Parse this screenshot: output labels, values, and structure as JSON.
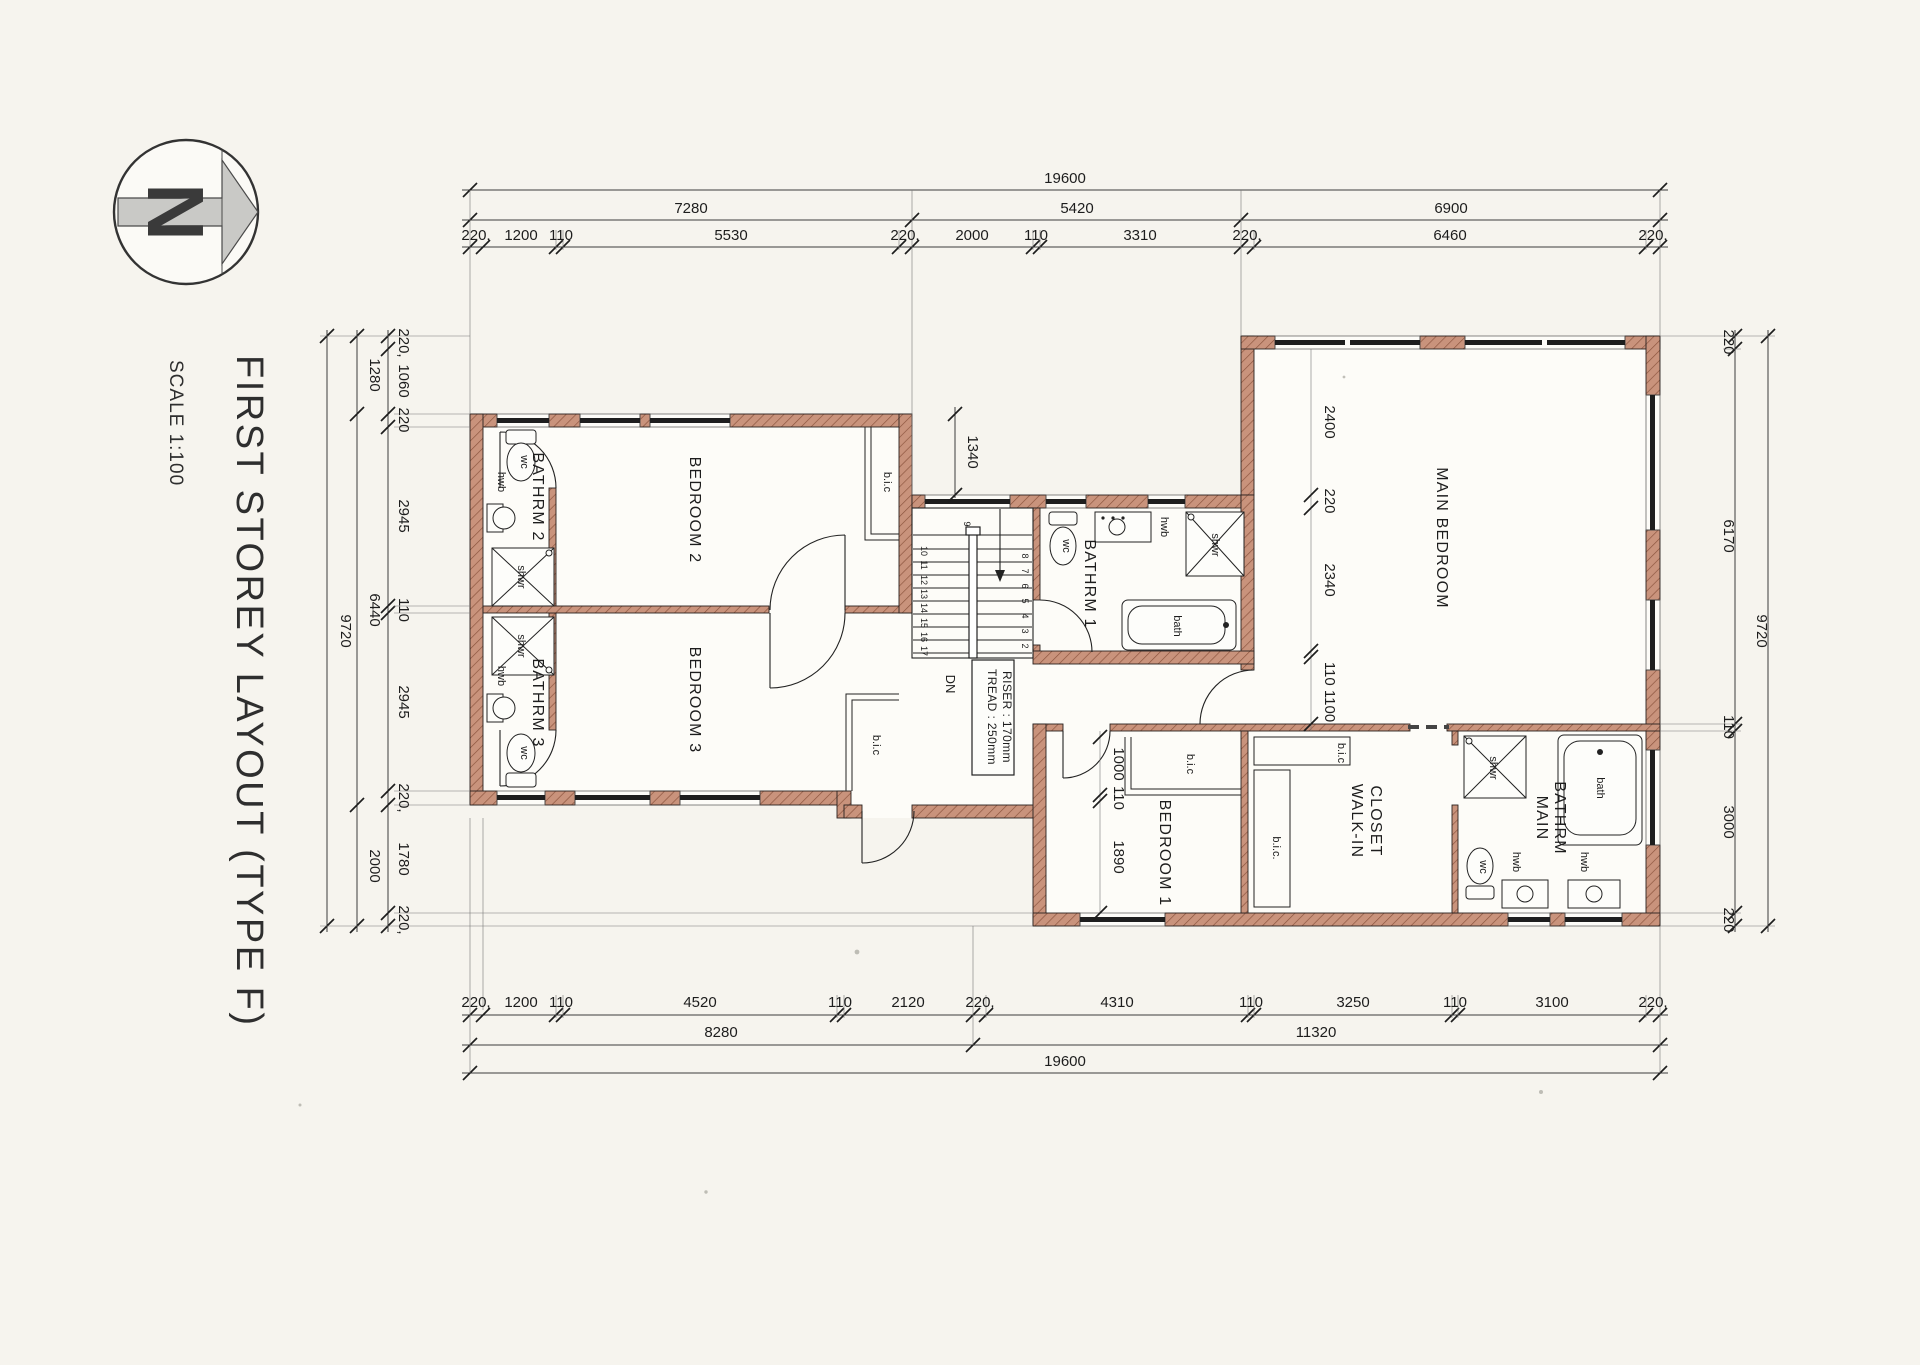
{
  "title": {
    "main": "FIRST STOREY LAYOUT (TYPE F)",
    "scale": "SCALE 1:100"
  },
  "compass": {
    "letter": "N"
  },
  "dims": {
    "top": {
      "overall": "19600",
      "mid": [
        "7280",
        "5420",
        "6900"
      ],
      "inner": [
        "220,",
        "1200",
        "110",
        "5530",
        "220,",
        "2000",
        "110",
        "3310",
        "220,",
        "6460",
        "220,"
      ]
    },
    "bottom": {
      "overall": "19600",
      "mid": [
        "8280",
        "11320"
      ],
      "inner": [
        "220,",
        "1200",
        "110",
        "4520",
        "110",
        "2120",
        "220,",
        "4310",
        "110",
        "3250",
        "110",
        "3100",
        "220,"
      ]
    },
    "left": {
      "overall": "9720",
      "mid": [
        "1280",
        "6440",
        "2000"
      ],
      "inner": [
        "220,",
        "1060",
        "220",
        "2945",
        "110",
        "2945",
        "220,",
        "1780",
        "220,"
      ]
    },
    "right": {
      "overall": "9720",
      "inner": [
        "220",
        "6170",
        "110",
        "3000",
        "220"
      ]
    },
    "interior": {
      "nook": "1340",
      "main_bedroom": [
        "2400",
        "220",
        "2340",
        "110 1100"
      ],
      "bedroom1": [
        "1000",
        "110",
        "1890"
      ]
    }
  },
  "rooms": {
    "bathrm2": "BATHRM 2",
    "bedroom2": "BEDROOM 2",
    "bedroom2_bic": "b.i.c",
    "bathrm3": "BATHRM 3",
    "bedroom3": "BEDROOM 3",
    "bedroom3_bic": "b.i.c",
    "bathrm1": "BATHRM 1",
    "main_bedroom": "MAIN BEDROOM",
    "bedroom1": "BEDROOM 1",
    "bedroom1_bic": "b.i.c",
    "closet_line1": "WALK-IN",
    "closet_line2": "CLOSET",
    "closet_bic_n": "b.i.c",
    "closet_bic_s": "b.i.c.",
    "main_bathrm_line1": "MAIN",
    "main_bathrm_line2": "BATHRM"
  },
  "fixtures": {
    "wc": "wc",
    "hwb": "hwb",
    "shwr": "shwr",
    "bath": "bath"
  },
  "stairs": {
    "dn": "DN",
    "note1": "TREAD : 250mm",
    "note2": "RISER : 170mm",
    "right": [
      "9",
      "8",
      "7",
      "6",
      "5",
      "4",
      "3",
      "2"
    ],
    "left": [
      "10",
      "11",
      "12",
      "13",
      "14",
      "15",
      "16",
      "17"
    ]
  }
}
